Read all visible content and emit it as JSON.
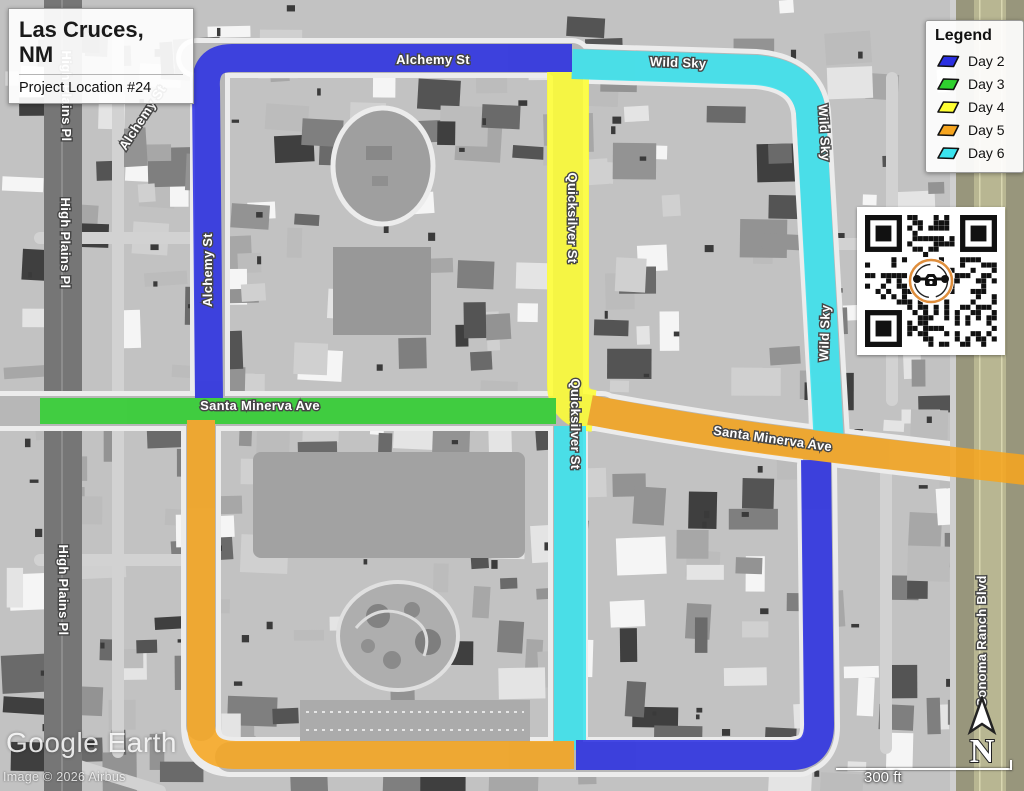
{
  "title_box": {
    "city_line1": "Las Cruces,",
    "city_line2": "NM",
    "subtitle": "Project Location #24"
  },
  "legend": {
    "title": "Legend",
    "items": [
      {
        "label": "Day 2",
        "color": "#2a2fe2"
      },
      {
        "label": "Day 3",
        "color": "#2fd02f"
      },
      {
        "label": "Day 4",
        "color": "#ffff33"
      },
      {
        "label": "Day 5",
        "color": "#f6a51f"
      },
      {
        "label": "Day 6",
        "color": "#3ae4ef"
      }
    ]
  },
  "routes": [
    {
      "day": "Day 2",
      "color": "#2a2fe2",
      "streets": "Alchemy St (north & west) + south & east perimeter"
    },
    {
      "day": "Day 3",
      "color": "#2fd02f",
      "streets": "Santa Minerva Ave (west)"
    },
    {
      "day": "Day 4",
      "color": "#ffff33",
      "streets": "Quicksilver St (north)"
    },
    {
      "day": "Day 5",
      "color": "#f6a51f",
      "streets": "Santa Minerva Ave (east) + west & south loop"
    },
    {
      "day": "Day 6",
      "color": "#3ae4ef",
      "streets": "Wild Sky + Quicksilver St (south)"
    }
  ],
  "map": {
    "street_labels": [
      {
        "text": "Alchemy St",
        "x": 433,
        "y": 64,
        "rot": 0
      },
      {
        "text": "Alchemy St",
        "x": 146,
        "y": 120,
        "rot": -57
      },
      {
        "text": "Alchemy St",
        "x": 212,
        "y": 270,
        "rot": -90
      },
      {
        "text": "Wild Sky",
        "x": 678,
        "y": 67,
        "rot": 2
      },
      {
        "text": "Wild Sky",
        "x": 820,
        "y": 133,
        "rot": 87
      },
      {
        "text": "Wild Sky",
        "x": 829,
        "y": 333,
        "rot": -88
      },
      {
        "text": "Quicksilver St",
        "x": 568,
        "y": 218,
        "rot": 90
      },
      {
        "text": "Quicksilver St",
        "x": 571,
        "y": 424,
        "rot": 90
      },
      {
        "text": "Santa Minerva Ave",
        "x": 260,
        "y": 410,
        "rot": 0
      },
      {
        "text": "Santa Minerva Ave",
        "x": 772,
        "y": 443,
        "rot": 8
      },
      {
        "text": "High Plains Pl",
        "x": 62,
        "y": 96,
        "rot": 90
      },
      {
        "text": "High Plains Pl",
        "x": 61,
        "y": 243,
        "rot": 90
      },
      {
        "text": "High Plains Pl",
        "x": 59,
        "y": 590,
        "rot": 90
      },
      {
        "text": "Sonoma Ranch Blvd",
        "x": 986,
        "y": 641,
        "rot": -90
      }
    ],
    "watermark": "Google Earth",
    "copyright": "Image © 2026 Airbus",
    "scale_label": "300 ft",
    "north_label": "N",
    "qr_ring_color": "#df8e3c"
  }
}
